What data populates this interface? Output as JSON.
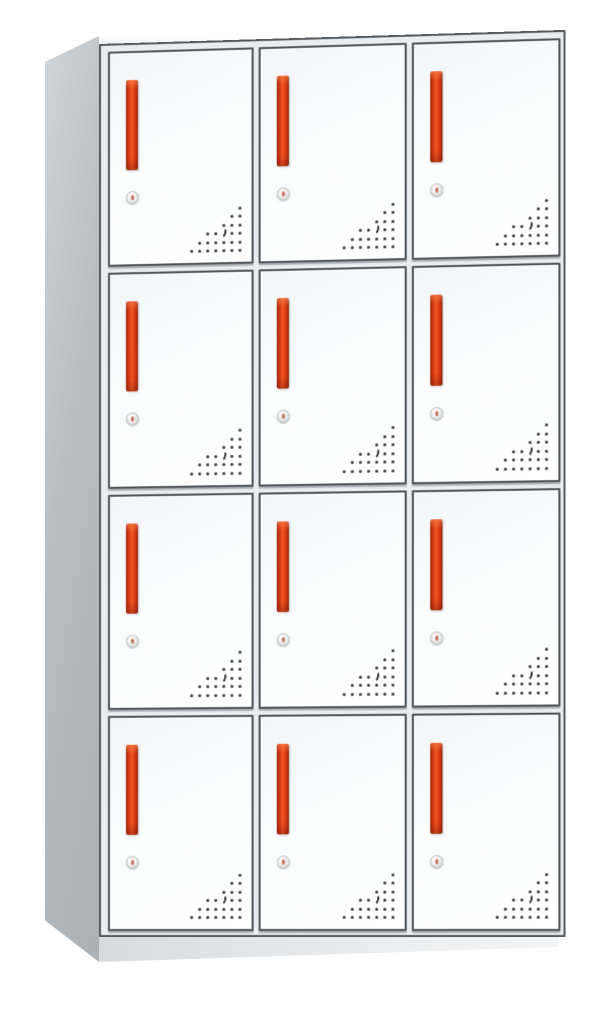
{
  "scene": {
    "subject": "white metal 12-door storage locker cabinet, three-quarter product view",
    "background_color": "#ffffff"
  },
  "cabinet": {
    "rows": 4,
    "columns": 3,
    "door_count": 12,
    "features_per_door": {
      "handle": "vertical red recessed handle",
      "lock": "round silver cam lock",
      "vents": "triangular perforated vent pattern with crescent cutout"
    },
    "colors": {
      "door_face": "#fafcfd",
      "door_border": "#50555a",
      "frame_background": "#e9edef",
      "side_panel": "#b6bdc3",
      "side_panel_highlight": "#cfd5d9",
      "side_panel_shadow": "#a9b0b6",
      "base_shadow": "#d6dbde",
      "handle_red_bright": "#ef5523",
      "handle_red_dark": "#9c2309",
      "lock_silver": "#cdd1cf",
      "lock_keyhole_accent": "#c06038",
      "vent_dot": "#35393c"
    },
    "vent_pattern": {
      "columns": 7,
      "rows": [
        [
          0,
          0,
          0,
          0,
          0,
          0,
          1
        ],
        [
          0,
          0,
          0,
          0,
          0,
          1,
          1
        ],
        [
          0,
          0,
          0,
          0,
          1,
          1,
          1
        ],
        [
          0,
          0,
          1,
          1,
          2,
          1,
          1
        ],
        [
          0,
          1,
          1,
          1,
          1,
          1,
          1
        ],
        [
          1,
          1,
          1,
          1,
          1,
          1,
          1
        ]
      ],
      "legend": {
        "0": "empty",
        "1": "vent hole",
        "2": "crescent cutout"
      }
    }
  }
}
